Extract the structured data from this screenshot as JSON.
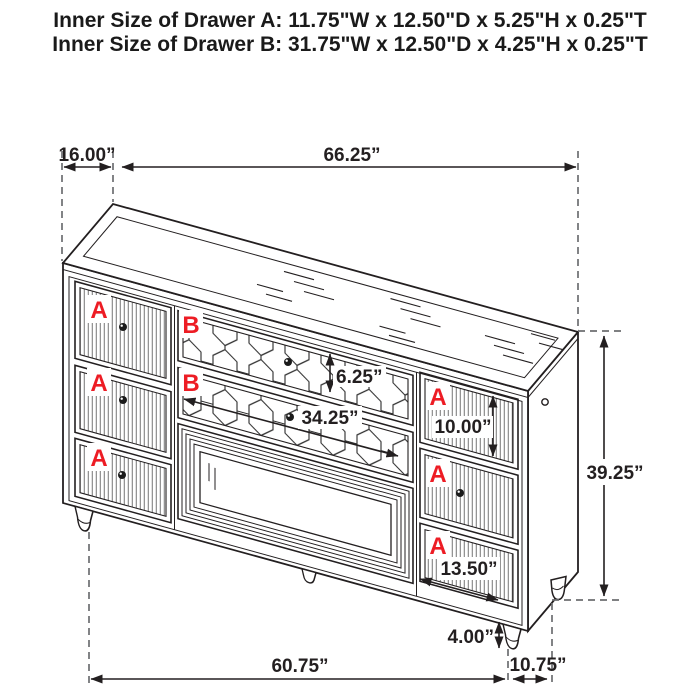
{
  "header": {
    "line1": "Inner Size of Drawer A: 11.75\"W x 12.50\"D x 5.25\"H x 0.25\"T",
    "line2": "Inner Size of Drawer B: 31.75\"W x 12.50\"D x 4.25\"H x 0.25\"T"
  },
  "dims": {
    "top_depth": "16.00”",
    "top_width": "66.25”",
    "drawer_b_front_height": "6.25”",
    "drawer_b_front_width": "34.25”",
    "drawer_a_front_height": "10.00”",
    "total_height": "39.25”",
    "drawer_a_front_width": "13.50”",
    "leg_height": "4.00”",
    "bottom_width": "60.75”",
    "bottom_depth": "10.75”"
  },
  "labels": {
    "drawer_a": "A",
    "drawer_b": "B"
  },
  "colors": {
    "label_red": "#ed1c24",
    "line_black": "#231f20",
    "dash_gray": "#6d6e71"
  }
}
